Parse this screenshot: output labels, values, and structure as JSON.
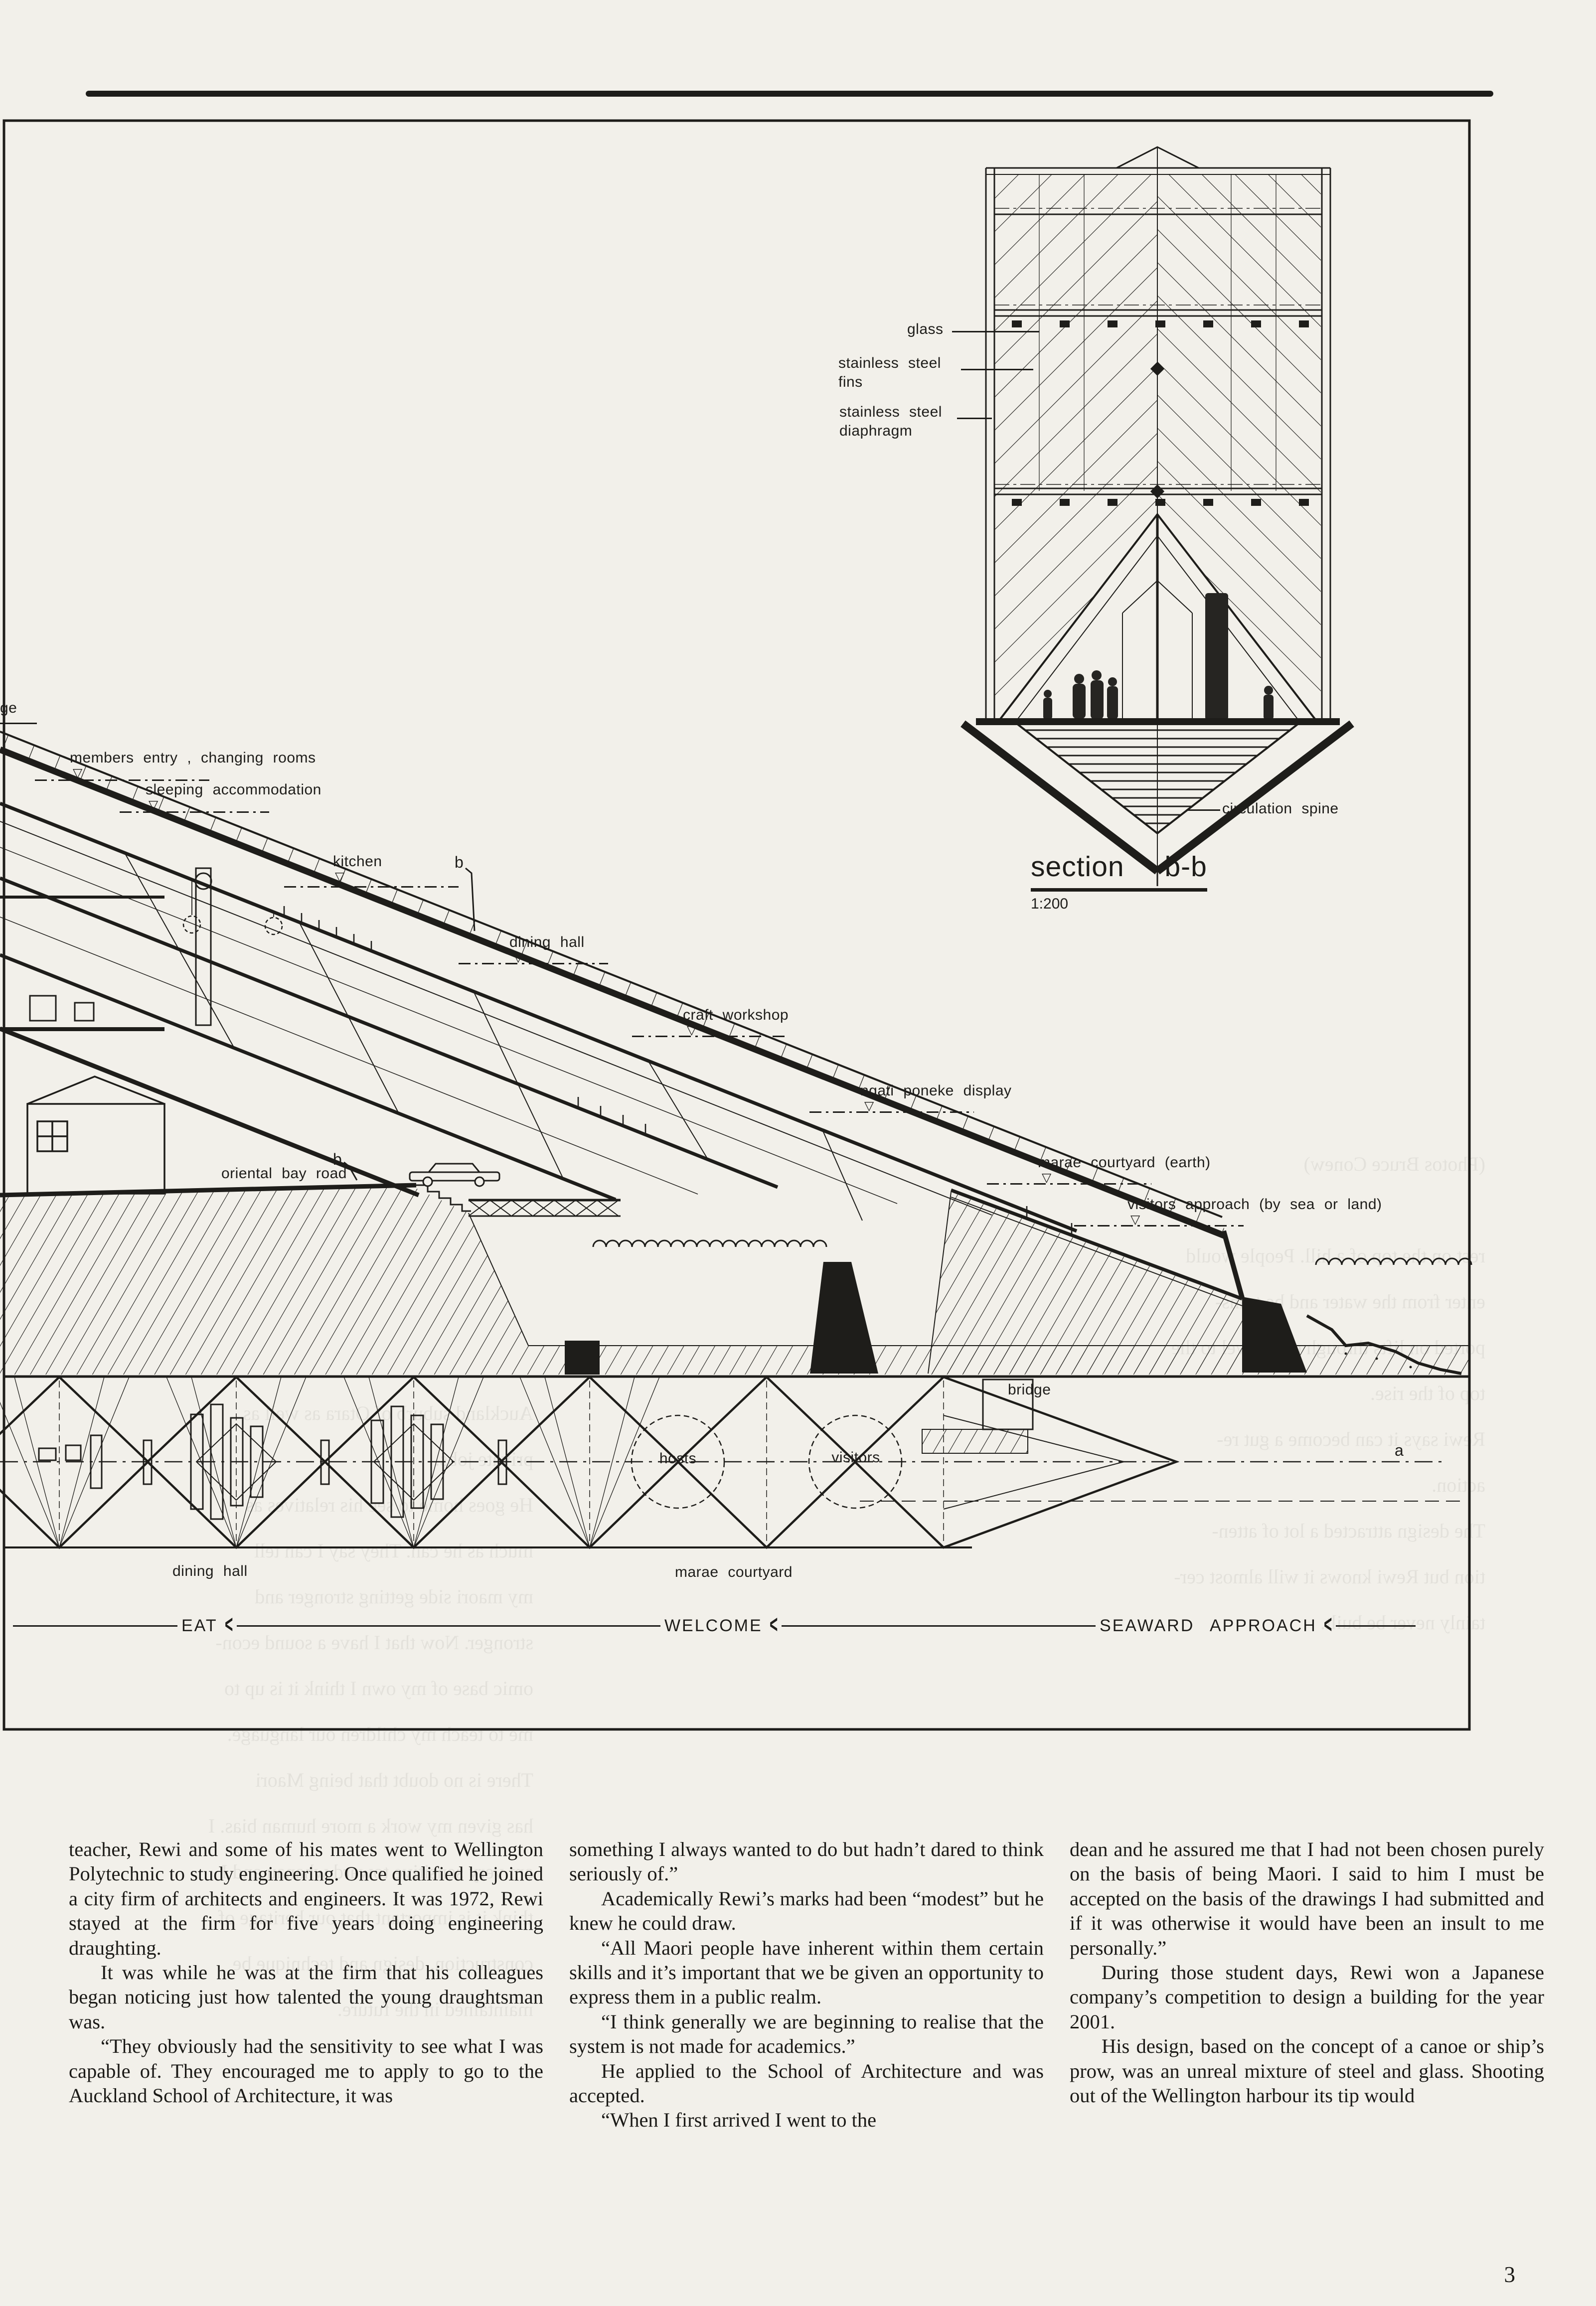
{
  "page": {
    "number": "3"
  },
  "section_bb": {
    "title": "section  b-b",
    "scale": "1:200",
    "labels": {
      "glass": "glass",
      "fins_line1": "stainless steel",
      "fins_line2": "fins",
      "diaphragm_line1": "stainless steel",
      "diaphragm_line2": "diaphragm",
      "circulation_spine": "circulation spine"
    }
  },
  "long_section": {
    "levels": [
      {
        "text": "ge"
      },
      {
        "text": "members entry , changing rooms"
      },
      {
        "text": "sleeping accommodation"
      },
      {
        "text": "kitchen"
      },
      {
        "text": "dining hall"
      },
      {
        "text": "craft workshop"
      },
      {
        "text": "ngati poneke display"
      },
      {
        "text": "marae courtyard (earth)"
      },
      {
        "text": "visitors approach  (by sea or land)"
      }
    ],
    "road_label": "oriental bay road",
    "bridge_label": "bridge",
    "marker_b_upper": "b",
    "marker_b_lower": "b",
    "marker_a": "a"
  },
  "plan": {
    "dining_hall": "dining hall",
    "marae_courtyard": "marae courtyard",
    "hosts": "hosts",
    "visitors": "visitors",
    "arrows": [
      {
        "text": "EAT"
      },
      {
        "text": "WELCOME"
      },
      {
        "text": "SEAWARD APPROACH"
      }
    ]
  },
  "article": {
    "columns": [
      {
        "paragraphs": [
          "teacher, Rewi and some of his mates went to Wellington Polytechnic to study engineering. Once qualified he joined a city firm of architects and engineers. It was 1972, Rewi stayed at the firm for five years doing engineering draughting.",
          "It was while he was at the firm that his colleagues began noticing just how talented the young draughtsman was.",
          "“They obviously had the sensitivity to see what I was capable of. They encouraged me to apply to go to the Auckland School of Architecture, it was"
        ]
      },
      {
        "paragraphs": [
          "something I always wanted to do but hadn’t dared to think seriously of.”",
          "Academically Rewi’s marks had been “modest” but he knew he could draw.",
          "“All Maori people have inherent within them certain skills and it’s important that we be given an opportunity to express them in a public realm.",
          "“I think generally we are beginning to realise that the system is not made for academics.”",
          "He applied to the School of Architecture and was accepted.",
          "“When I first arrived I went to the"
        ]
      },
      {
        "paragraphs": [
          "dean and he assured me that I had not been chosen purely on the basis of being Maori. I said to him I must be accepted on the basis of the drawings I had submitted and if it was otherwise it would have been an insult to me personally.”",
          "During those student days, Rewi won a Japanese company’s competition to design a building for the year 2001.",
          "His design, based on the concept of a canoe or ship’s prow, was an unreal mixture of steel and glass. Shooting out of the Wellington harbour its tip would"
        ]
      }
    ]
  },
  "bleed_through": {
    "block_right": "(Photos Bruce Conew)\n\nrest on the top of a hill. People would\nenter from the water and be trans-\nported on lifts through each level to the\ntop of the rise.\nRewi says it can become a gut re-\naction.\nThe design attracted a lot of atten-\ntion but Rewi knows it will almost cer-\ntainly never be built.",
    "block_left": "Auckland suburb of Otara as well as\nprivate jobs.\nHe goes home to see his relatives as\nmuch as he can. They say I can tell\nmy maori side getting stronger and\nstronger. Now that I have a sound econ-\nomic base of my own I think it is up to\nme to teach my children our language.\nThere is no doubt that being Maori\nhas given my work a more human bias. I\nam very sensitive toward whanau and I\nthink it is important that our heritage of\nconstruction, design and technique be\nmaintained in the future."
  }
}
